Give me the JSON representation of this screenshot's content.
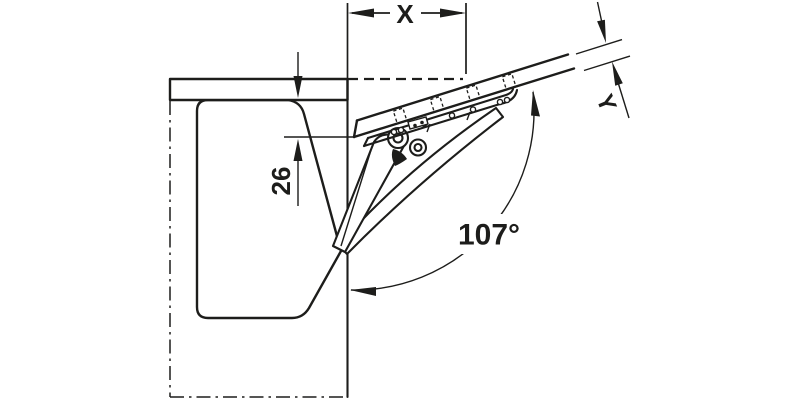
{
  "diagram": {
    "labels": {
      "x_dimension": "X",
      "y_dimension": "Y",
      "inset_dimension": "26",
      "opening_angle": "107°"
    },
    "colors": {
      "line": "#1d1d1b",
      "background": "#ffffff"
    }
  }
}
